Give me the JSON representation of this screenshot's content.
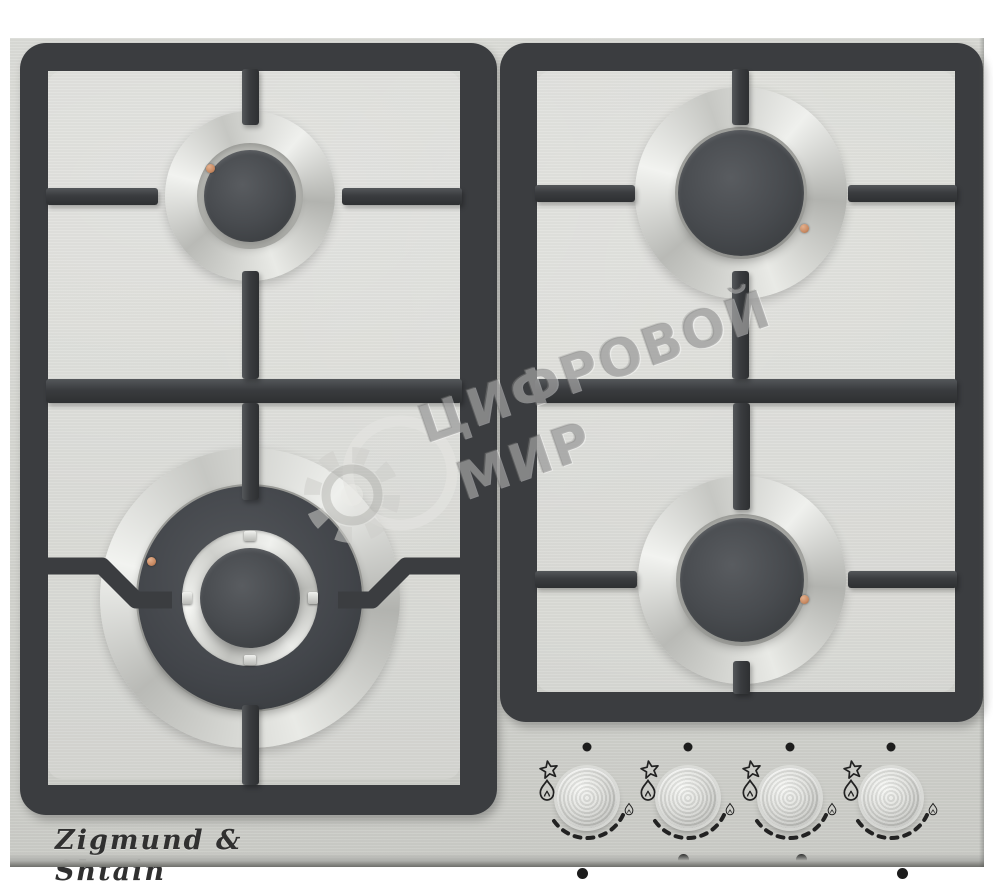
{
  "product": {
    "brand": "Zigmund & Shtain",
    "category": "4-burner gas hob, stainless steel, cast-iron grates"
  },
  "watermark": {
    "line1": "ЦИФРОВОЙ",
    "line2": "МИР",
    "logo": "gear-and-globe"
  },
  "burners": [
    {
      "id": "rear-left",
      "size": "small"
    },
    {
      "id": "rear-right",
      "size": "large"
    },
    {
      "id": "front-left",
      "size": "wok-double-ring"
    },
    {
      "id": "front-right",
      "size": "large"
    }
  ],
  "control_panel": {
    "symbols": {
      "off": "dot",
      "ignition": "spark-star",
      "max_flame": "large-flame",
      "min_flame": "small-flame"
    },
    "knobs": [
      {
        "id": "knob-1",
        "controls": "front-left",
        "indicator_dots": [
          false,
          false,
          true,
          false
        ]
      },
      {
        "id": "knob-2",
        "controls": "rear-left",
        "indicator_dots": [
          true,
          false,
          false,
          false
        ]
      },
      {
        "id": "knob-3",
        "controls": "rear-right",
        "indicator_dots": [
          false,
          true,
          false,
          false
        ]
      },
      {
        "id": "knob-4",
        "controls": "front-right",
        "indicator_dots": [
          false,
          false,
          false,
          true
        ]
      }
    ]
  },
  "colors": {
    "background": "#ffffff",
    "steel_surface": "#d5d6d1",
    "grate": "#3b3d40",
    "burner_cap": "#45484b",
    "igniter": "#c98a62",
    "markings": "#222222",
    "watermark": "#7d7d7d"
  }
}
